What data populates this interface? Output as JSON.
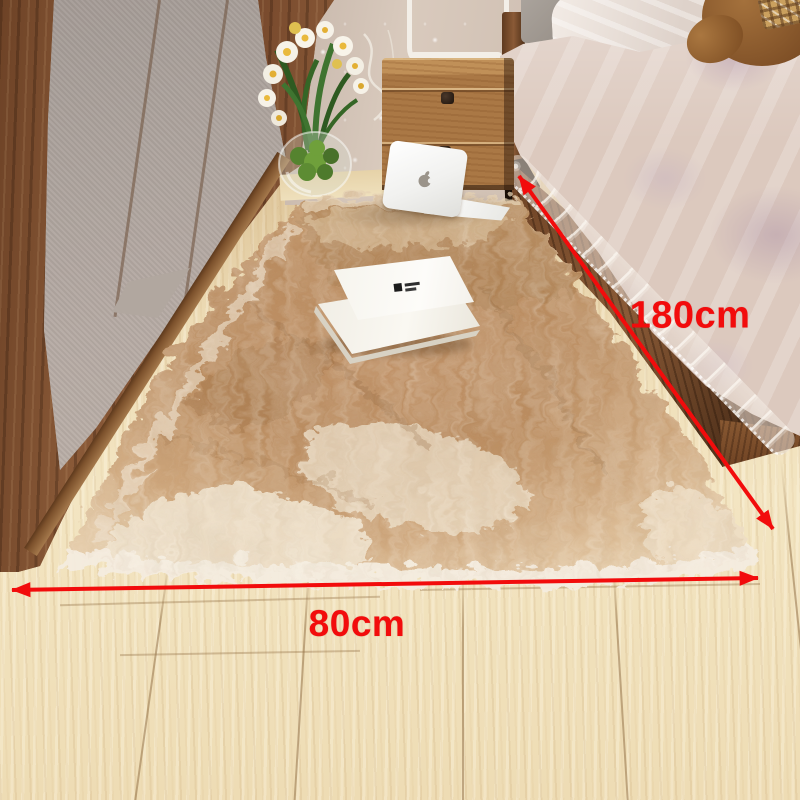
{
  "annotations": {
    "length_label": "180cm",
    "width_label": "80cm",
    "arrow_color": "#f20c0c"
  },
  "palette": {
    "floor_wood": "#eedcb4",
    "rug_tan": "#ba8c60",
    "rug_cream": "#eee1cb",
    "rug_fringe_white": "#f4ecdf",
    "closet_wood": "#7c4e2d",
    "closet_panel_gray": "#aca29c",
    "wall_beige": "#d3c3b6",
    "nightstand_wood": "#aa7845",
    "bedding_champagne": "#dcc9be",
    "bedding_floral_lavender": "#baa0b2",
    "teddy_brown": "#8d5a2e",
    "laptop_white": "#f4f4f2"
  }
}
